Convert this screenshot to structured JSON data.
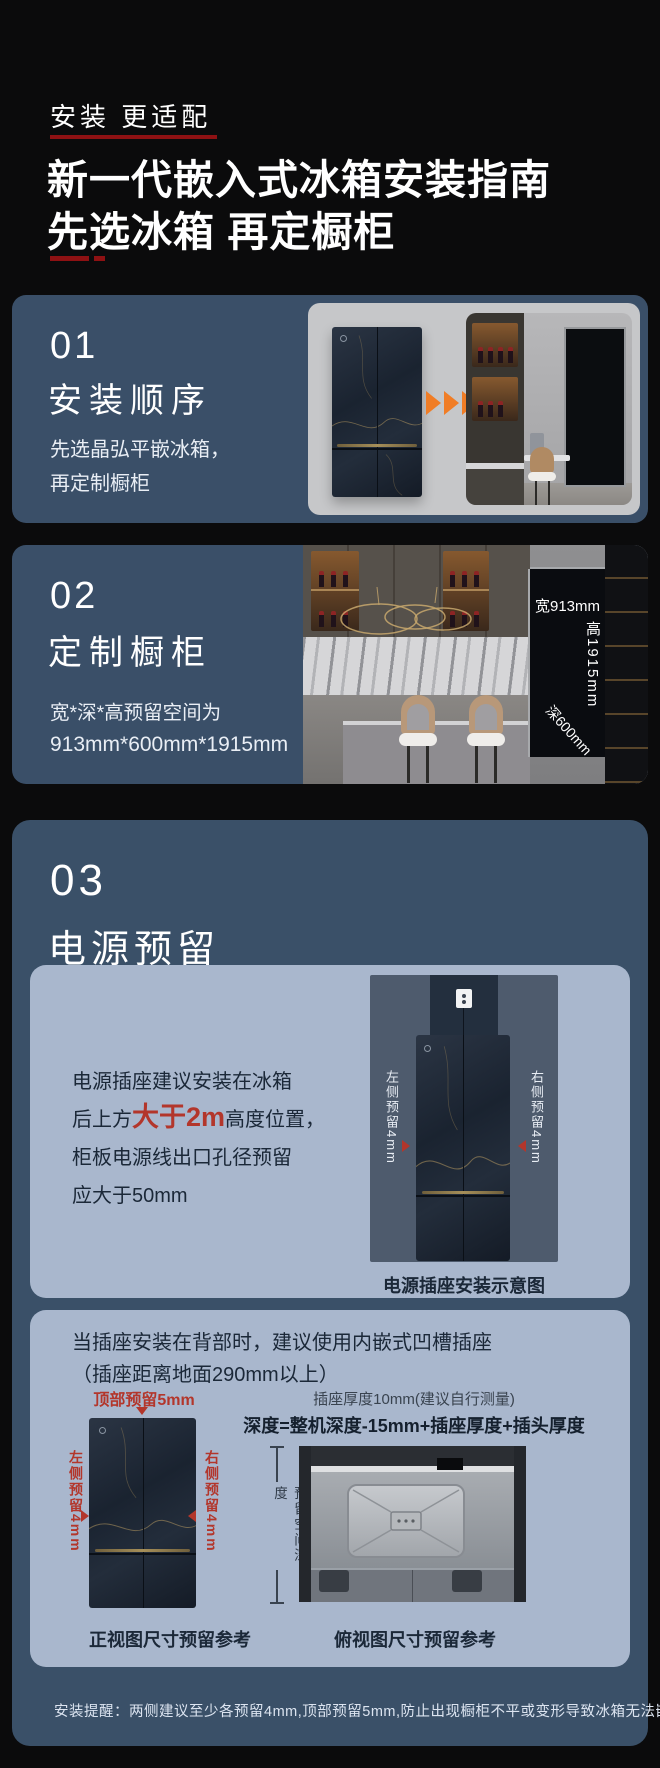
{
  "colors": {
    "page_bg": "#0B0B0C",
    "card_blue": "#3A4F68",
    "card_blue_deep": "#3A5068",
    "subcard_blue": "#A9B7CD",
    "accent_red_dark": "#8E1113",
    "label_red": "#B3362B",
    "arrow_orange": "#F07D26",
    "photo_gray": "#C6C7C9",
    "panel_slate": "#4E5B6D",
    "text_dark": "#1B2838",
    "text_white": "#FFFFFF"
  },
  "hero": {
    "eyebrow": "安装 更适配",
    "title_line1": "新一代嵌入式冰箱安装指南",
    "title_line2": "先选冰箱 再定橱柜"
  },
  "step1": {
    "number": "01",
    "title": "安装顺序",
    "desc_line1": "先选晶弘平嵌冰箱，",
    "desc_line2": "再定制橱柜"
  },
  "step2": {
    "number": "02",
    "title": "定制橱柜",
    "desc_line1": "宽*深*高预留空间为",
    "desc_line2": "913mm*600mm*1915mm",
    "label_width": "宽913mm",
    "label_height": "高1915mm",
    "label_depth": "深600mm"
  },
  "step3": {
    "number": "03",
    "title": "电源预留",
    "socket_card": {
      "line1": "电源插座建议安装在冰箱",
      "line2_prefix": "后上方",
      "line2_highlight": "大于2m",
      "line2_suffix": "高度位置，",
      "line3": "柜板电源线出口孔径预留",
      "line4": "应大于50mm",
      "label_left": "左侧预留4mm",
      "label_right": "右侧预留4mm",
      "caption": "电源插座安装示意图"
    },
    "recess_card": {
      "line1": "当插座安装在背部时，建议使用内嵌式凹槽插座",
      "line2": "（插座距离地面290mm以上）",
      "label_top": "顶部预留5mm",
      "label_left": "左侧预留4mm",
      "label_right": "右侧预留4mm",
      "socket_thickness_note": "插座厚度10mm(建议自行测量)",
      "depth_formula": "深度=整机深度-15mm+插座厚度+插头厚度",
      "reserve_depth_label": "预留空间深度",
      "caption_front": "正视图尺寸预留参考",
      "caption_top": "俯视图尺寸预留参考"
    },
    "note": "安装提醒：两侧建议至少各预留4mm,顶部预留5mm,防止出现橱柜不平或变形导致冰箱无法嵌入"
  }
}
